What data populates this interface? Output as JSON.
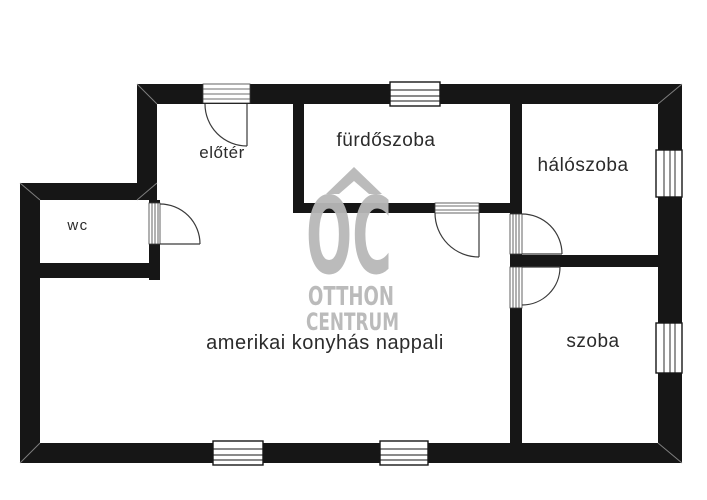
{
  "floorplan": {
    "rooms": [
      {
        "name": "eloter",
        "label": "előtér"
      },
      {
        "name": "furdoszoba",
        "label": "fürdőszoba"
      },
      {
        "name": "haloszoba",
        "label": "hálószoba"
      },
      {
        "name": "wc",
        "label": "wc"
      },
      {
        "name": "nappali",
        "label": "amerikai konyhás nappali"
      },
      {
        "name": "szoba",
        "label": "szoba"
      }
    ],
    "watermark": {
      "logo": "OC",
      "line1": "OTTHON",
      "line2": "CENTRUM"
    },
    "colors": {
      "wall": "#161616",
      "watermark": "#b8b8b8",
      "label_text": "#2b2b2b",
      "door_line": "#3a3a3a",
      "background": "#ffffff"
    }
  }
}
